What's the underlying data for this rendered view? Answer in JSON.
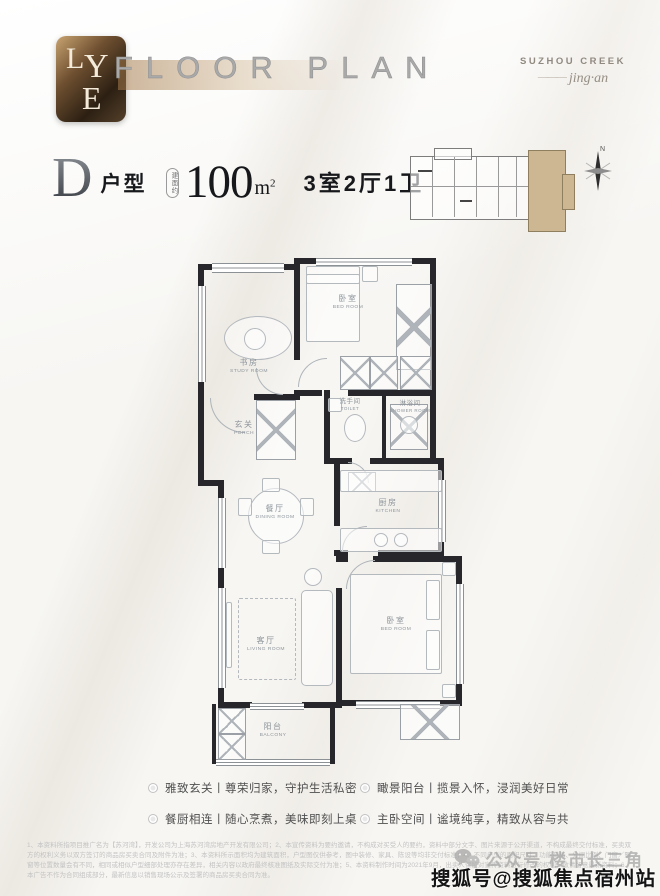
{
  "brand": {
    "logo_letters": [
      "L",
      "Y",
      "E"
    ],
    "floor_plan_title": "FLOOR PLAN",
    "project_name": "SUZHOU CREEK",
    "project_dash": "———",
    "project_sub": "jing·an"
  },
  "unit": {
    "letter": "D",
    "type_label": "户型",
    "area_tag": "建面约",
    "area_value": "100",
    "area_unit": "m",
    "area_sup": "2",
    "spec": "3室2厅1卫"
  },
  "compass_label": "N",
  "rooms": {
    "study": {
      "cn": "书房",
      "en": "STUDY ROOM"
    },
    "bedroom2": {
      "cn": "卧室",
      "en": "BED ROOM"
    },
    "porch": {
      "cn": "玄关",
      "en": "PORCH"
    },
    "toilet": {
      "cn": "洗手间",
      "en": "TOILET"
    },
    "shower": {
      "cn": "淋浴间",
      "en": "SHOWER ROOM"
    },
    "dining": {
      "cn": "餐厅",
      "en": "DINING ROOM"
    },
    "kitchen": {
      "cn": "厨房",
      "en": "KITCHEN"
    },
    "living": {
      "cn": "客厅",
      "en": "LIVING ROOM"
    },
    "master": {
      "cn": "卧室",
      "en": "BED ROOM"
    },
    "balcony": {
      "cn": "阳台",
      "en": "BALCONY"
    }
  },
  "features": [
    "雅致玄关丨尊荣归家，守护生活私密",
    "餐厨相连丨随心烹煮，美味即刻上桌",
    "瞰景阳台丨揽景入怀，浸润美好日常",
    "主卧空间丨谧境纯享，精致从容与共"
  ],
  "disclaimer": "1、本资料所指项目推广名为【苏河湾】，开发公司为上海苏河湾房地产开发有限公司；2、本宣传资料为要约邀请，不构成对买受人的要约，资料中部分文字、图片来源于公开渠道，不构成最终交付标准，买卖双方的权利义务以双方签订的商品房买卖合同及附件为准；3、本资料所示面积均为建筑面积，户型图仅供参考，图中装修、家具、陈设等均非交付标准；4、不同户型的面积尺寸、功能布局、分间比例、门窗／飘窗等位置数量会有不同，相同或相似户型细部处理亦存在差异，相关内容以政府最终核准图纸及实际交付为准；5、本资料制作时间为2021年9月，出卖人保留对宣传资料进行修改的权利，敬请留意最新资料；6、本广告不作为合同组成部分，最新信息以销售现场公示及签署的商品房买卖合同为准。",
  "watermarks": {
    "wechat": "公众号 楼市长三角",
    "sohu": "搜狐号@搜狐焦点宿州站"
  },
  "colors": {
    "wall": "#26262b",
    "unit_highlight": "#cdb792",
    "bronze": "#a97f4f"
  }
}
